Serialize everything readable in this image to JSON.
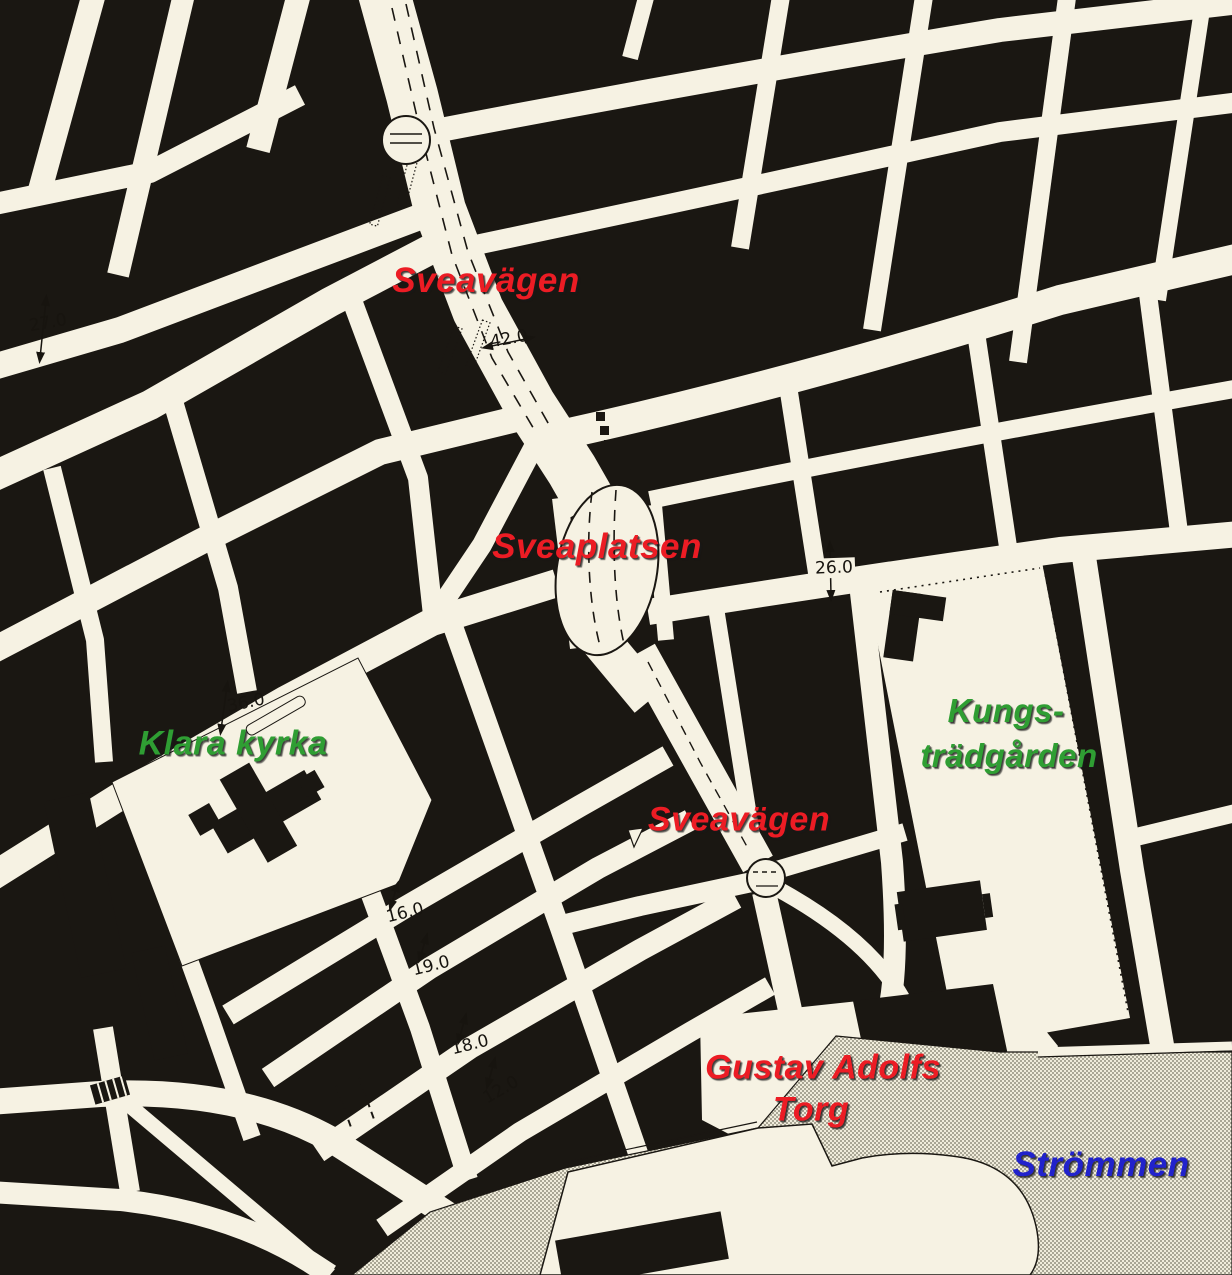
{
  "map": {
    "kind": "scanned city plan, Stockholm centre",
    "colors": {
      "paper": "#f6f2e3",
      "ink": "#1a1712",
      "water_dot": "#a9a695",
      "label_red": "#ec1c24",
      "label_green": "#2f9e33",
      "label_blue": "#2122cc"
    },
    "place_labels": {
      "sveavagen_north": {
        "text": "Sveavägen",
        "color": "#ec1c24"
      },
      "sveaplatsen": {
        "text": "Sveaplatsen",
        "color": "#ec1c24"
      },
      "klara_kyrka": {
        "text": "Klara kyrka",
        "color": "#2f9e33"
      },
      "kungstradgarden": {
        "line1": "Kungs-",
        "line2": "trädgården",
        "color": "#2f9e33"
      },
      "sveavagen_south": {
        "text": "Sveavägen",
        "color": "#ec1c24"
      },
      "gustav_adolfs_torg": {
        "line1": "Gustav Adolfs",
        "line2": "Torg",
        "color": "#ec1c24"
      },
      "strommen": {
        "text": "Strömmen",
        "color": "#2122cc"
      }
    },
    "street_width_measurements": [
      "27.0",
      "42.0",
      "36.0",
      "26.0",
      "16.0",
      "19.0",
      "18.0",
      "12.0"
    ]
  }
}
